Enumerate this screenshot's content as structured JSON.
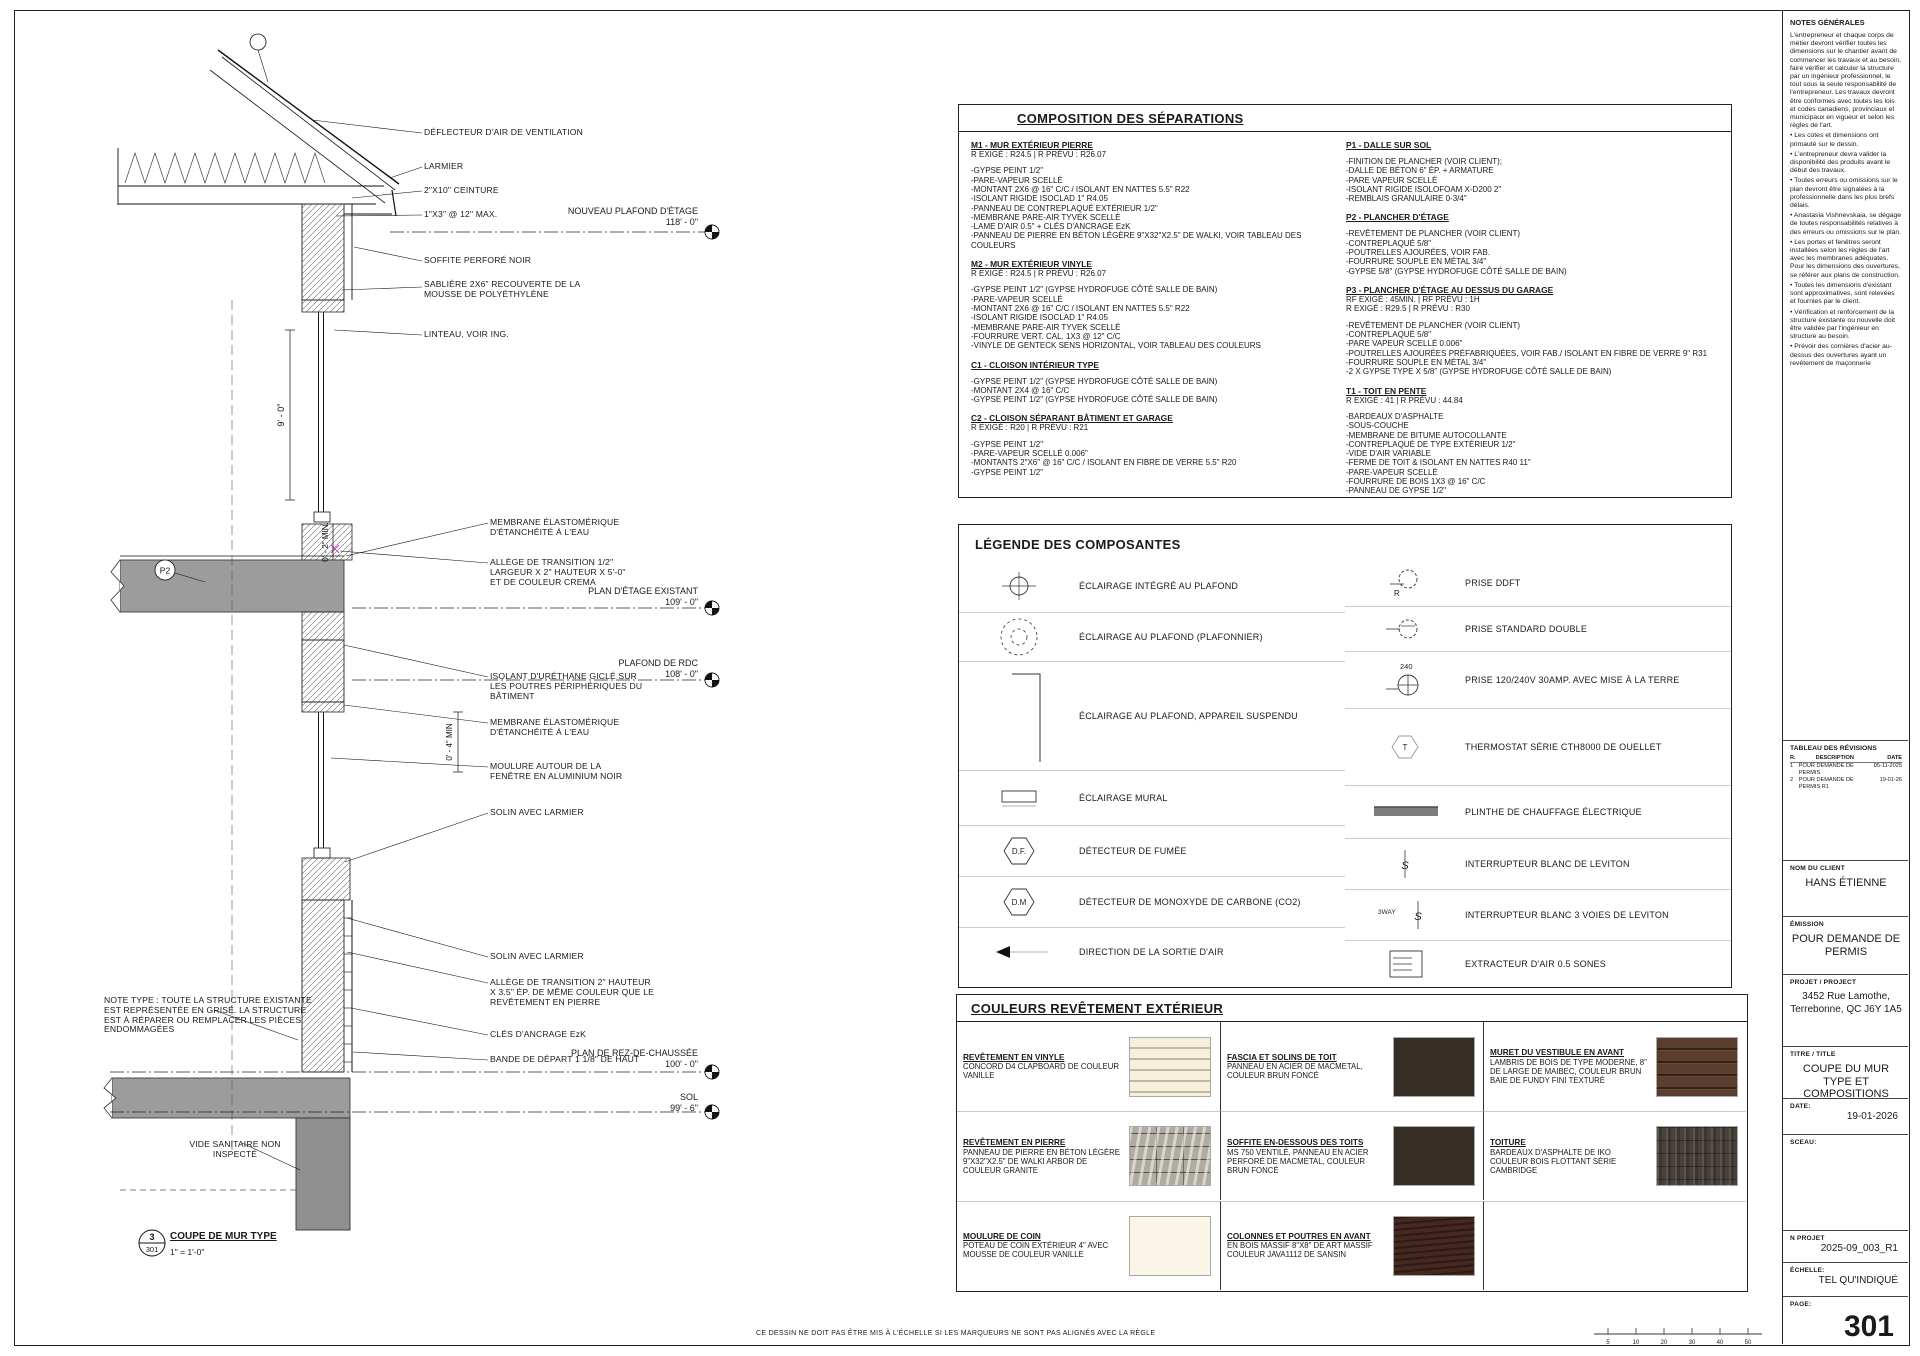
{
  "compositions": {
    "title": "COMPOSITION DES SÉPARATIONS",
    "m1": {
      "title": "M1 - MUR EXTÉRIEUR PIERRE",
      "subtitle": "R EXIGÉ : R24.5 | R PRÉVU : R26.07",
      "items": [
        "-GYPSE PEINT 1/2\"",
        "-PARE-VAPEUR SCELLÉ",
        "-MONTANT 2X6 @ 16\" C/C / ISOLANT EN NATTES 5.5\" R22",
        "-ISOLANT RIGIDE ISOCLAD 1\" R4.05",
        "-PANNEAU DE CONTREPLAQUÉ EXTÉRIEUR 1/2\"",
        "-MEMBRANE PARE-AIR TYVEK SCELLÉ",
        "-LAME D'AIR 0.5\" + CLÉS D'ANCRAGE EzK",
        "-PANNEAU DE PIERRE EN BÉTON LÉGÈRE 9\"X32\"X2.5\" DE WALKI, VOIR TABLEAU DES COULEURS"
      ]
    },
    "m2": {
      "title": "M2 - MUR EXTÉRIEUR VINYLE",
      "subtitle": "R EXIGÉ : R24.5 | R PRÉVU : R26.07",
      "items": [
        "-GYPSE PEINT 1/2\" (GYPSE HYDROFUGE CÔTÉ SALLE DE BAIN)",
        "-PARE-VAPEUR SCELLÉ",
        "-MONTANT 2X6 @ 16\" C/C / ISOLANT EN NATTES 5.5\" R22",
        "-ISOLANT RIGIDE ISOCLAD 1\" R4.05",
        "-MEMBRANE PARE-AIR TYVEK SCELLÉ",
        "-FOURRURE VERT. CAL. 1X3 @ 12\" C/C",
        "-VINYLE DE GENTECK SENS HORIZONTAL, VOIR TABLEAU DES COULEURS"
      ]
    },
    "c1": {
      "title": "C1 - CLOISON INTÉRIEUR TYPE",
      "items": [
        "-GYPSE PEINT 1/2\" (GYPSE HYDROFUGE CÔTÉ SALLE DE BAIN)",
        "-MONTANT 2X4 @ 16\" C/C",
        "-GYPSE PEINT 1/2\" (GYPSE HYDROFUGE CÔTÉ SALLE DE BAIN)"
      ]
    },
    "c2": {
      "title": "C2 - CLOISON SÉPARANT BÂTIMENT ET GARAGE",
      "subtitle": "R EXIGÉ : R20 | R PRÉVU : R21",
      "items": [
        "-GYPSE PEINT 1/2\"",
        "-PARE-VAPEUR SCELLÉ 0.006\"",
        "-MONTANTS 2\"X6\" @ 16\" C/C / ISOLANT EN FIBRE DE VERRE 5.5\" R20",
        "-GYPSE PEINT 1/2\""
      ]
    },
    "p1": {
      "title": "P1 - DALLE SUR SOL",
      "items": [
        "-FINITION DE PLANCHER (VOIR CLIENT);",
        "-DALLE DE BÉTON 6\" ÉP. + ARMATURE",
        "-PARE VAPEUR SCELLÉ",
        "-ISOLANT RIGIDE ISOLOFOAM X-D200 2\"",
        "-REMBLAIS GRANULAIRE 0-3/4\""
      ]
    },
    "p2": {
      "title": "P2 - PLANCHER D'ÉTAGE",
      "items": [
        "-REVÊTEMENT DE PLANCHER (VOIR CLIENT)",
        "-CONTREPLAQUÉ 5/8\"",
        "-POUTRELLES AJOURÉES, VOIR FAB.",
        "-FOURRURE SOUPLE EN MÉTAL 3/4\"",
        "-GYPSE 5/8\" (GYPSE HYDROFUGE CÔTÉ SALLE DE BAIN)"
      ]
    },
    "p3": {
      "title": "P3 - PLANCHER D'ÉTAGE AU DESSUS DU GARAGE",
      "subtitle": "RF EXIGÉ : 45MIN. | RF PRÉVU : 1H",
      "subtitle2": "R EXIGÉ : R29.5 | R PRÉVU : R30",
      "items": [
        "-REVÊTEMENT DE PLANCHER (VOIR CLIENT)",
        "-CONTREPLAQUÉ 5/8\"",
        "-PARE VAPEUR SCELLÉ 0.006\"",
        "-POUTRELLES AJOURÉES PRÉFABRIQUÉES, VOIR FAB./ ISOLANT EN FIBRE DE VERRE 9\" R31",
        "-FOURRURE SOUPLE EN MÉTAL 3/4\"",
        "-2 X GYPSE TYPE X 5/8\" (GYPSE HYDROFUGE CÔTÉ SALLE DE BAIN)"
      ]
    },
    "t1": {
      "title": "T1 - TOIT EN PENTE",
      "subtitle": "R EXIGÉ : 41 | R PRÉVU : 44.84",
      "items": [
        "-BARDEAUX D'ASPHALTE",
        "-SOUS-COUCHE",
        "-MEMBRANE DE BITUME AUTOCOLLANTE",
        "-CONTREPLAQUÉ DE TYPE EXTÉRIEUR 1/2\"",
        "-VIDE D'AIR VARIABLE",
        "-FERME DE TOIT & ISOLANT EN NATTES R40 11\"",
        "-PARE-VAPEUR SCELLÉ",
        "-FOURRURE DE BOIS 1X3 @ 16\" C/C",
        "-PANNEAU DE GYPSE 1/2\""
      ]
    }
  },
  "legend": {
    "title": "LÉGENDE DES COMPOSANTES",
    "left": [
      {
        "label": "ÉCLAIRAGE INTÉGRÉ AU PLAFOND"
      },
      {
        "label": "ÉCLAIRAGE AU PLAFOND (PLAFONNIER)"
      },
      {
        "label": "ÉCLAIRAGE AU PLAFOND, APPAREIL SUSPENDU"
      },
      {
        "label": "ÉCLAIRAGE MURAL"
      },
      {
        "label": "DÉTECTEUR DE FUMÉE"
      },
      {
        "label": "DÉTECTEUR DE MONOXYDE DE CARBONE (CO2)"
      },
      {
        "label": "DIRECTION DE LA SORTIE D'AIR"
      }
    ],
    "right": [
      {
        "label": "PRISE DDFT"
      },
      {
        "label": "PRISE STANDARD DOUBLE"
      },
      {
        "label": "PRISE 120/240V 30AMP. AVEC MISE À LA TERRE"
      },
      {
        "label": "THERMOSTAT SÉRIE CTH8000 DE OUELLET"
      },
      {
        "label": "PLINTHE DE CHAUFFAGE ÉLECTRIQUE"
      },
      {
        "label": "INTERRUPTEUR BLANC DE LEVITON"
      },
      {
        "label": "INTERRUPTEUR BLANC 3 VOIES DE LEVITON"
      },
      {
        "label": "EXTRACTEUR D'AIR 0.5 SONES"
      }
    ],
    "symbols": {
      "df": "D.F.",
      "dm": "D.M",
      "t": "T",
      "r": "R",
      "v240": "240",
      "s": "S",
      "way3": "3WAY"
    }
  },
  "colors": {
    "title": "COULEURS REVÊTEMENT EXTÉRIEUR",
    "cells": [
      {
        "title": "REVÊTEMENT EN VINYLE",
        "desc": "CONCORD D4 CLAPBOARD DE COULEUR VANILLE",
        "swatch": "#f6efdd"
      },
      {
        "title": "FASCIA ET SOLINS DE TOIT",
        "desc": "PANNEAU EN ACIER DE MACMETAL, COULEUR BRUN FONCÉ",
        "swatch": "#362d24"
      },
      {
        "title": "MURET DU VESTIBULE EN AVANT",
        "desc": "LAMBRIS DE BOIS DE TYPE MODERNE, 8\" DE LARGE DE MAIBEC, COULEUR BRUN BAIE DE FUNDY FINI TEXTURÉ",
        "swatch": "#5d3e2e"
      },
      {
        "title": "REVÊTEMENT EN PIERRE",
        "desc": "PANNEAU DE PIERRE EN BÉTON LÉGÈRE 9\"X32\"X2.5\" DE WALKI ARBOR DE COULEUR GRANITE",
        "swatch": "#b0aba1"
      },
      {
        "title": "SOFFITE EN-DESSOUS DES TOITS",
        "desc": "MS 750 VENTILÉ, PANNEAU EN ACIER PERFORÉ DE MACMETAL, COULEUR BRUN FONCÉ",
        "swatch": "#362d24"
      },
      {
        "title": "TOITURE",
        "desc": "BARDEAUX D'ASPHALTE DE IKO COULEUR BOIS FLOTTANT SÉRIE CAMBRIDGE",
        "swatch": "#49423a"
      },
      {
        "title": "MOULURE DE COIN",
        "desc": "POTEAU DE COIN EXTÉRIEUR 4\" AVEC MOUSSE DE COULEUR VANILLE",
        "swatch": "#faf5e6"
      },
      {
        "title": "COLONNES ET POUTRES EN AVANT",
        "desc": "EN BOIS MASSIF 8\"X8\" DE ART MASSIF COULEUR JAVA1112 DE SANSIN",
        "swatch": "#45281f"
      }
    ]
  },
  "drawing": {
    "annotations": [
      "DÉFLECTEUR D'AIR DE VENTILATION",
      "LARMIER",
      "2\"X10\" CEINTURE",
      "1\"X3\" @ 12\" MAX.",
      "SOFFITE PERFORÉ NOIR",
      "SABLIÈRE 2X6\" RECOUVERTE DE LA MOUSSE DE POLYÉTHYLÈNE",
      "LINTEAU, VOIR ING.",
      "MEMBRANE ÉLASTOMÉRIQUE D'ÉTANCHÉITÉ À L'EAU",
      "ALLÈGE DE TRANSITION 1/2\" LARGEUR X 2\" HAUTEUR X 5'-0\" ET DE COULEUR CREMA",
      "ISOLANT D'URÉTHANE GICLÉ SUR LES POUTRES PÉRIPHÉRIQUES DU BÂTIMENT",
      "MEMBRANE ÉLASTOMÉRIQUE D'ÉTANCHÉITÉ À L'EAU",
      "MOULURE AUTOUR DE LA FENÊTRE EN ALUMINIUM NOIR",
      "SOLIN AVEC LARMIER",
      "SOLIN AVEC LARMIER",
      "ALLÈGE DE TRANSITION 2\" HAUTEUR X 3.5\" ÉP. DE MÊME COULEUR QUE LE REVÊTEMENT EN PIERRE",
      "CLÉS D'ANCRAGE EzK",
      "BANDE DE DÉPART 1 1/8\" DE HAUT",
      "VIDE SANITAIRE NON INSPECTÉ",
      "NOTE TYPE : TOUTE LA STRUCTURE EXISTANTE EST REPRÉSENTÉE EN GRISÉ. LA STRUCTURE EST À RÉPARER OU REMPLACER LES PIÈCES ENDOMMAGÉES"
    ],
    "levels": [
      {
        "label": "NOUVEAU PLAFOND D'ÉTAGE",
        "elev": "118' - 0\""
      },
      {
        "label": "PLAN D'ÉTAGE EXISTANT",
        "elev": "109' - 0\""
      },
      {
        "label": "PLAFOND DE RDC",
        "elev": "108' - 0\""
      },
      {
        "label": "PLAN DE REZ-DE-CHAUSSÉE",
        "elev": "100' - 0\""
      },
      {
        "label": "SOL",
        "elev": "99' - 6\""
      }
    ],
    "dims": {
      "v9": "9' - 0\"",
      "min2": "0' - 2\" MIN.",
      "min4": "0' - 4\" MIN"
    },
    "tag_p2": "P2",
    "detail": {
      "num": "3",
      "sheet": "301",
      "title": "COUPE DE MUR TYPE",
      "scale": "1\" = 1'-0\""
    }
  },
  "sidebar": {
    "notes_title": "NOTES GÉNÉRALES",
    "notes": [
      "L'entrepreneur et chaque corps de métier devront vérifier toutes les dimensions sur le chantier avant de commencer les travaux et au besoin, faire vérifier et calculer la structure par un ingénieur professionnel, le tout sous la seule responsabilité de l'entrepreneur. Les travaux devront être conformes avec toutes les lois et codes canadiens, provinciaux et municipaux en vigueur et selon les règles de l'art.",
      "• Les cotes et dimensions ont primauté sur le dessin.",
      "• L'entrepreneur devra valider la disponibilité des produits avant le début des travaux.",
      "• Toutes erreurs ou omissions sur le plan devront être signalées à la professionnelle dans les plus brefs délais.",
      "• Anastasia Vishnevskaia, se dégage de toutes responsabilités relatives à des erreurs ou omissions sur le plan.",
      "• Les portes et fenêtres seront installées selon les règles de l'art avec les membranes adéquates. Pour les dimensions des ouvertures, se référer aux plans de construction.",
      "• Toutes les dimensions d'existant sont approximatives, sont relevées et fournies par le client.",
      "• Vérification et renforcement de la structure existante ou nouvelle doit être validée par l'ingénieur en structure au besoin.",
      "• Prévoir des cornières d'acier au-dessus des ouvertures ayant un revêtement de maçonnerie"
    ],
    "revisions": {
      "title": "TABLEAU DES RÉVISIONS",
      "col_r": "R.",
      "col_desc": "DESCRIPTION",
      "col_date": "DATE",
      "rows": [
        {
          "r": "1",
          "desc": "POUR DEMANDE DE PERMIS",
          "date": "05-11-2025"
        },
        {
          "r": "2",
          "desc": "POUR DEMANDE DE PERMIS R1",
          "date": "19-01-26"
        }
      ]
    },
    "client_label": "NOM DU CLIENT",
    "client": "HANS ÉTIENNE",
    "emission_label": "ÉMISSION",
    "emission": "POUR DEMANDE DE PERMIS",
    "project_label": "PROJET / PROJECT",
    "project": "3452 Rue Lamothe, Terrebonne, QC J6Y 1A5",
    "title_label": "TITRE / TITLE",
    "title": "COUPE DU MUR TYPE ET COMPOSITIONS",
    "date_label": "DATE:",
    "date": "19-01-2026",
    "seal_label": "SCEAU:",
    "nproj_label": "N PROJET",
    "nproj": "2025-09_003_R1",
    "scale_label": "ÉCHELLE:",
    "scale": "TEL QU'INDIQUÉ",
    "page_label": "PAGE:",
    "page": "301",
    "end_num": "100"
  },
  "footer": {
    "note": "CE DESSIN NE DOIT PAS ÊTRE MIS À L'ÉCHELLE SI LES MARQUEURS NE SONT PAS ALIGNÉS AVEC LA RÈGLE",
    "ruler": [
      "5",
      "10",
      "20",
      "30",
      "40",
      "50"
    ]
  }
}
